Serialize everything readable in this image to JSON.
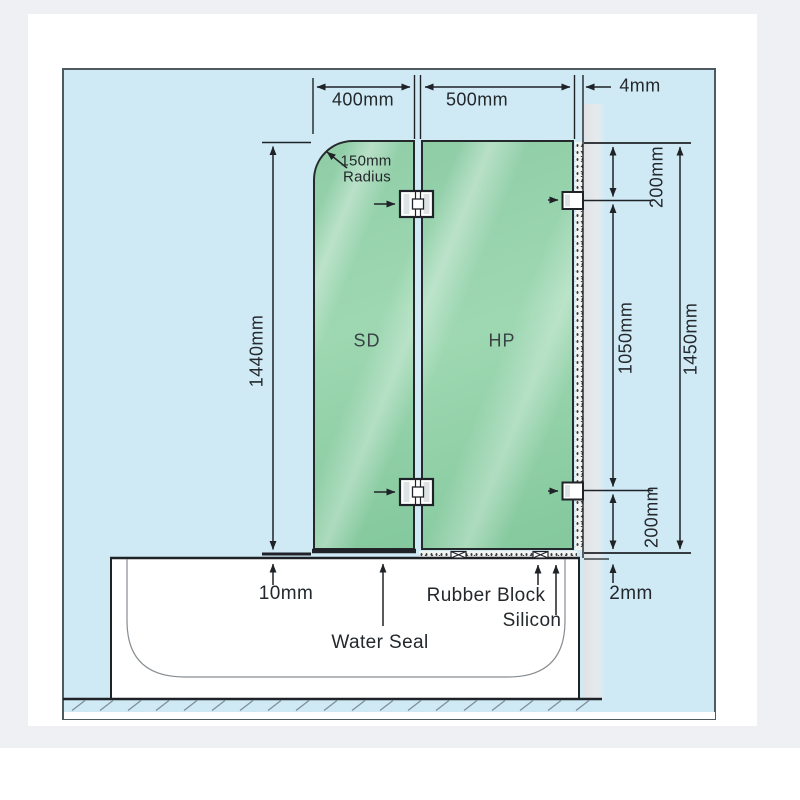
{
  "diagram_title": "Bath shower screen installation diagram",
  "dimensions": {
    "sd_width": "400mm",
    "hp_width": "500mm",
    "wall_gap": "4mm",
    "sd_height": "1440mm",
    "top_hinge_offset": "200mm",
    "hinge_spacing": "1050mm",
    "hp_height": "1450mm",
    "bottom_hinge_offset": "200mm",
    "bath_gap": "10mm",
    "floor_gap": "2mm"
  },
  "panels": {
    "left_label": "SD",
    "right_label": "HP"
  },
  "annotations": {
    "radius_line1": "150mm",
    "radius_line2": "Radius",
    "water_seal": "Water Seal",
    "rubber_block": "Rubber Block",
    "silicon": "Silicon"
  },
  "colors": {
    "background_blue": "#cfe9f5",
    "glass_green": "#8fcda7",
    "glass_highlight": "#bde6cb",
    "wall_gray": "#e2e6e9",
    "line_dark": "#1f2327",
    "page_gray": "#eef0f3"
  }
}
